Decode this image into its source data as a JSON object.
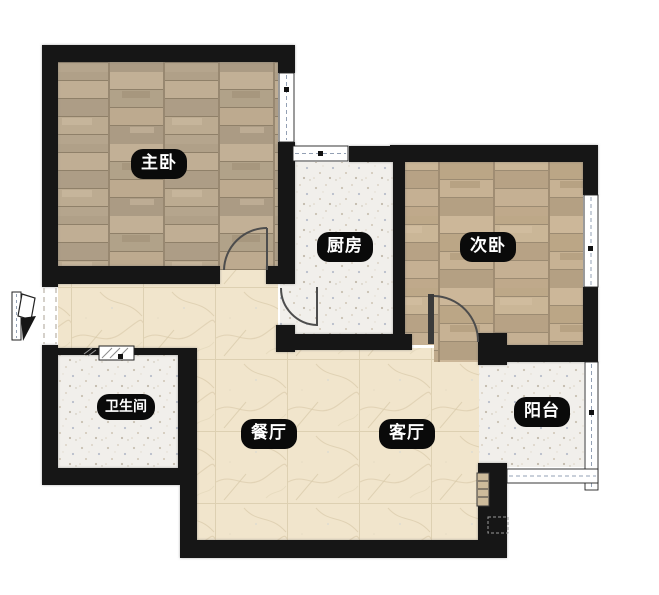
{
  "rooms": [
    {
      "key": "master-bedroom",
      "name": "主卧"
    },
    {
      "key": "kitchen",
      "name": "厨房"
    },
    {
      "key": "second-bedroom",
      "name": "次卧"
    },
    {
      "key": "bathroom",
      "name": "卫生间"
    },
    {
      "key": "dining-room",
      "name": "餐厅"
    },
    {
      "key": "living-room",
      "name": "客厅"
    },
    {
      "key": "balcony",
      "name": "阳台"
    }
  ],
  "colors": {
    "bg": "#ffffff",
    "wall": "#161616",
    "wood-a": "#b9a893",
    "wood-b": "#c3ae91",
    "tile-white": "#f1efeb",
    "marble": "#f1e5cc",
    "label-bg": "#0a0a0a",
    "label-text": "#ffffff",
    "door": "#4d4d4d",
    "window-dash": "#93a0b4"
  }
}
